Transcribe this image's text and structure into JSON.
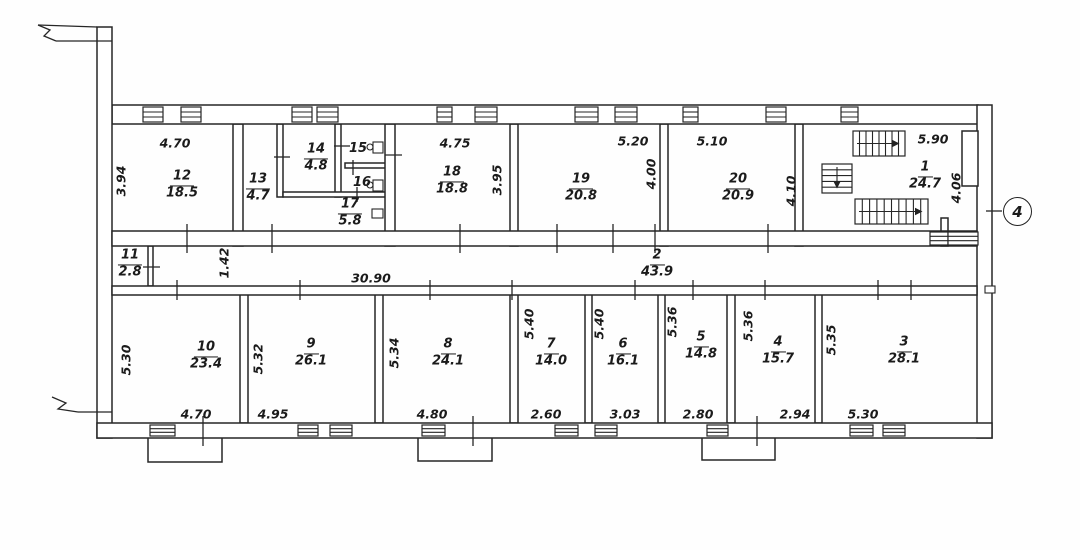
{
  "marker": {
    "label": "4"
  },
  "rooms": [
    {
      "number": "12",
      "area": "18.5",
      "x": 182,
      "y": 185
    },
    {
      "number": "13",
      "area": "4.7",
      "x": 258,
      "y": 188
    },
    {
      "number": "14",
      "area": "4.8",
      "x": 316,
      "y": 158
    },
    {
      "number": "15",
      "area": "",
      "x": 358,
      "y": 150
    },
    {
      "number": "16",
      "area": "",
      "x": 362,
      "y": 184
    },
    {
      "number": "17",
      "area": "5.8",
      "x": 350,
      "y": 213
    },
    {
      "number": "18",
      "area": "18.8",
      "x": 452,
      "y": 181
    },
    {
      "number": "19",
      "area": "20.8",
      "x": 581,
      "y": 188
    },
    {
      "number": "20",
      "area": "20.9",
      "x": 738,
      "y": 188
    },
    {
      "number": "1",
      "area": "24.7",
      "x": 925,
      "y": 176
    },
    {
      "number": "11",
      "area": "2.8",
      "x": 130,
      "y": 264
    },
    {
      "number": "2",
      "area": "43.9",
      "x": 657,
      "y": 264
    },
    {
      "number": "10",
      "area": "23.4",
      "x": 206,
      "y": 356
    },
    {
      "number": "9",
      "area": "26.1",
      "x": 311,
      "y": 353
    },
    {
      "number": "8",
      "area": "24.1",
      "x": 448,
      "y": 353
    },
    {
      "number": "7",
      "area": "14.0",
      "x": 551,
      "y": 353
    },
    {
      "number": "6",
      "area": "16.1",
      "x": 623,
      "y": 353
    },
    {
      "number": "5",
      "area": "14.8",
      "x": 701,
      "y": 346
    },
    {
      "number": "4",
      "area": "15.7",
      "x": 778,
      "y": 351
    },
    {
      "number": "3",
      "area": "28.1",
      "x": 904,
      "y": 351
    }
  ],
  "dimensions": [
    {
      "text": "4.70",
      "x": 175,
      "y": 143,
      "v": false
    },
    {
      "text": "3.94",
      "x": 121,
      "y": 181,
      "v": true
    },
    {
      "text": "4.75",
      "x": 455,
      "y": 143,
      "v": false
    },
    {
      "text": "3.95",
      "x": 497,
      "y": 180,
      "v": true
    },
    {
      "text": "5.20",
      "x": 633,
      "y": 141,
      "v": false
    },
    {
      "text": "4.00",
      "x": 651,
      "y": 174,
      "v": true
    },
    {
      "text": "5.10",
      "x": 712,
      "y": 141,
      "v": false
    },
    {
      "text": "4.10",
      "x": 791,
      "y": 191,
      "v": true
    },
    {
      "text": "5.90",
      "x": 933,
      "y": 139,
      "v": false
    },
    {
      "text": "4.06",
      "x": 956,
      "y": 188,
      "v": true
    },
    {
      "text": "1.42",
      "x": 224,
      "y": 263,
      "v": true
    },
    {
      "text": "30.90",
      "x": 371,
      "y": 278,
      "v": false
    },
    {
      "text": "5.30",
      "x": 126,
      "y": 360,
      "v": true
    },
    {
      "text": "4.70",
      "x": 196,
      "y": 414,
      "v": false
    },
    {
      "text": "5.32",
      "x": 258,
      "y": 359,
      "v": true
    },
    {
      "text": "4.95",
      "x": 273,
      "y": 414,
      "v": false
    },
    {
      "text": "5.34",
      "x": 394,
      "y": 353,
      "v": true
    },
    {
      "text": "4.80",
      "x": 432,
      "y": 414,
      "v": false
    },
    {
      "text": "5.40",
      "x": 529,
      "y": 324,
      "v": true
    },
    {
      "text": "2.60",
      "x": 546,
      "y": 414,
      "v": false
    },
    {
      "text": "5.40",
      "x": 599,
      "y": 324,
      "v": true
    },
    {
      "text": "3.03",
      "x": 625,
      "y": 414,
      "v": false
    },
    {
      "text": "5.36",
      "x": 672,
      "y": 322,
      "v": true
    },
    {
      "text": "2.80",
      "x": 698,
      "y": 414,
      "v": false
    },
    {
      "text": "5.36",
      "x": 748,
      "y": 326,
      "v": true
    },
    {
      "text": "2.94",
      "x": 795,
      "y": 414,
      "v": false
    },
    {
      "text": "5.35",
      "x": 831,
      "y": 340,
      "v": true
    },
    {
      "text": "5.30",
      "x": 863,
      "y": 414,
      "v": false
    }
  ],
  "geometry": {
    "porches": [
      [
        148,
        437,
        74,
        25
      ],
      [
        418,
        437,
        74,
        24
      ],
      [
        702,
        437,
        73,
        23
      ]
    ],
    "walls": [
      [
        233,
        124,
        10,
        122
      ],
      [
        277,
        124,
        6,
        73
      ],
      [
        335,
        124,
        6,
        73
      ],
      [
        345,
        163,
        42,
        5
      ],
      [
        283,
        192,
        104,
        5
      ],
      [
        385,
        124,
        10,
        122
      ],
      [
        510,
        124,
        8,
        122
      ],
      [
        660,
        124,
        8,
        122
      ],
      [
        795,
        124,
        8,
        122
      ],
      [
        941,
        218,
        7,
        28
      ],
      [
        148,
        246,
        5,
        40
      ],
      [
        240,
        294,
        8,
        129
      ],
      [
        375,
        294,
        8,
        129
      ],
      [
        510,
        294,
        8,
        129
      ],
      [
        585,
        294,
        7,
        129
      ],
      [
        658,
        294,
        7,
        129
      ],
      [
        727,
        294,
        8,
        129
      ],
      [
        815,
        294,
        7,
        129
      ],
      [
        112,
        105,
        866,
        19
      ],
      [
        97,
        27,
        15,
        411
      ],
      [
        977,
        105,
        15,
        333
      ],
      [
        112,
        231,
        865,
        15
      ],
      [
        112,
        286,
        865,
        9
      ],
      [
        97,
        423,
        895,
        15
      ],
      [
        962,
        131,
        16,
        55
      ]
    ],
    "windows_top": [
      [
        143,
        20
      ],
      [
        181,
        20
      ],
      [
        292,
        20
      ],
      [
        317,
        21
      ],
      [
        437,
        15
      ],
      [
        475,
        22
      ],
      [
        575,
        23
      ],
      [
        615,
        22
      ],
      [
        683,
        15
      ],
      [
        766,
        20
      ],
      [
        841,
        17
      ]
    ],
    "windows_corridor": [
      [
        930,
        18
      ],
      [
        948,
        30
      ]
    ],
    "windows_bottom": [
      [
        150,
        25
      ],
      [
        298,
        20
      ],
      [
        330,
        22
      ],
      [
        422,
        23
      ],
      [
        555,
        23
      ],
      [
        595,
        22
      ],
      [
        707,
        21
      ],
      [
        850,
        23
      ],
      [
        883,
        22
      ]
    ],
    "door_gaps_bottom": [
      [
        190,
        27
      ],
      [
        460,
        27
      ],
      [
        743,
        29
      ]
    ],
    "stairs": [
      {
        "x": 853,
        "y": 131,
        "w": 52,
        "h": 25,
        "dir": "h",
        "treads": 7
      },
      {
        "x": 822,
        "y": 164,
        "w": 30,
        "h": 29,
        "dir": "v",
        "treads": 4
      },
      {
        "x": 855,
        "y": 199,
        "w": 73,
        "h": 25,
        "dir": "h",
        "treads": 9
      }
    ],
    "ticks": [
      [
        187,
        224,
        187,
        253
      ],
      [
        272,
        224,
        272,
        253
      ],
      [
        460,
        224,
        460,
        253
      ],
      [
        557,
        224,
        557,
        253
      ],
      [
        613,
        224,
        613,
        253
      ],
      [
        655,
        224,
        655,
        253
      ],
      [
        768,
        224,
        768,
        253
      ],
      [
        177,
        280,
        177,
        300
      ],
      [
        300,
        280,
        300,
        300
      ],
      [
        430,
        280,
        430,
        300
      ],
      [
        512,
        280,
        512,
        300
      ],
      [
        635,
        280,
        635,
        300
      ],
      [
        693,
        280,
        693,
        300
      ],
      [
        765,
        280,
        765,
        300
      ],
      [
        878,
        280,
        878,
        300
      ],
      [
        911,
        280,
        911,
        300
      ],
      [
        203,
        416,
        203,
        446
      ],
      [
        473,
        416,
        473,
        446
      ],
      [
        757,
        416,
        757,
        446
      ],
      [
        143,
        267,
        160,
        267
      ],
      [
        274,
        157,
        290,
        157
      ],
      [
        334,
        146,
        350,
        146
      ],
      [
        353,
        160,
        353,
        175
      ],
      [
        357,
        187,
        357,
        202
      ],
      [
        385,
        155,
        402,
        155
      ],
      [
        986,
        211,
        1002,
        211
      ]
    ],
    "fixtures": [
      {
        "rect": [
          373,
          142,
          10,
          11
        ],
        "circle": [
          370,
          147
        ]
      },
      {
        "rect": [
          373,
          180,
          10,
          11
        ],
        "circle": [
          370,
          185
        ]
      },
      {
        "rect": [
          372,
          209,
          11,
          9
        ]
      }
    ],
    "breaks": [
      "38,25 50,30 44,36 56,41",
      "56,41 112,41",
      "38,25 97,27",
      "52,397 66,403 58,409 78,412",
      "78,412 112,412"
    ],
    "small_rects": [
      [
        985,
        286,
        10,
        7
      ]
    ]
  }
}
